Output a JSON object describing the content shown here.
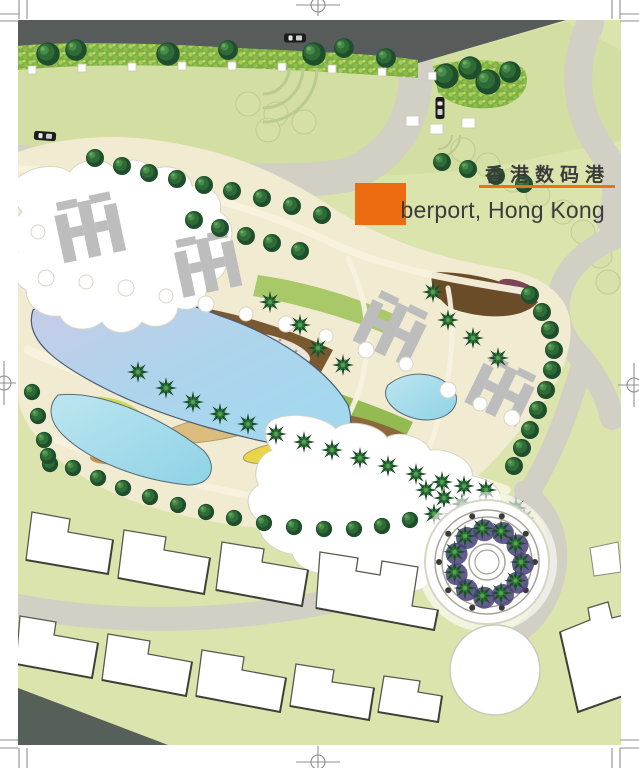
{
  "title": {
    "zh": "香港数码港",
    "en_accent": "Cy",
    "en_rest": "berport, Hong Kong"
  },
  "colors": {
    "accent-orange": "#ED6C11",
    "rule-orange": "#E87511",
    "title-text": "#3B3B3B",
    "road-dark": "#575C5B",
    "road-light": "#D2D0C4",
    "lawn": "#DCE4AE",
    "lawn-upper": "#D2DEA2",
    "terrain-cream": "#F1EBD1",
    "path-cream": "#F8F3DF",
    "lake-violet": "#C9CBE8",
    "lake-blue": "#A7D8EF",
    "pond-cyan": "#9EDAEA",
    "hedge-green": "#7FAE46",
    "tree-dark": "#1E4E2B",
    "tree-mid": "#2F6B36",
    "bed-brown": "#7A5931",
    "bed-brown-dark": "#6B4C28",
    "bed-tan": "#DCBC7C",
    "bed-orange": "#E2873E",
    "bed-yellow": "#EAD54A",
    "plaza-violet": "#4A3F7A",
    "shadow-slate": "#566058"
  }
}
